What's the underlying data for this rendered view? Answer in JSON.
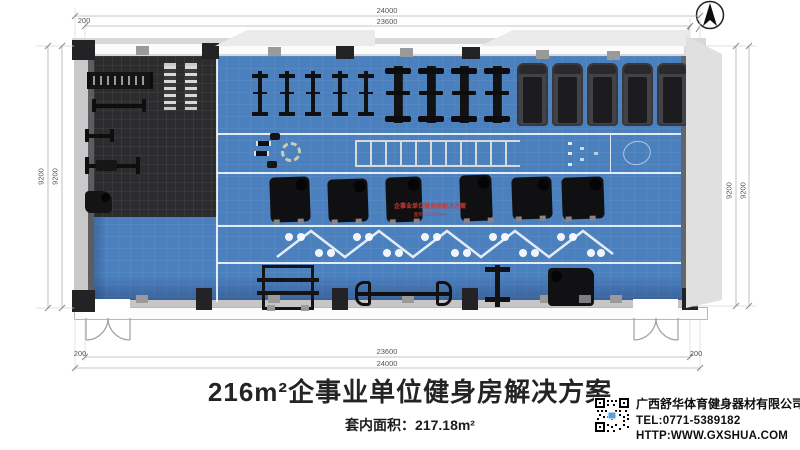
{
  "dimensions": {
    "top_outer": "24000",
    "top_inner": "23600",
    "top_offset": "200",
    "bottom_inner": "23600",
    "bottom_outer": "24000",
    "bottom_offset_left": "200",
    "bottom_offset_right": "200",
    "left_outer": "9200",
    "left_inner": "9200",
    "right_inner": "9200",
    "right_outer": "9200"
  },
  "plan": {
    "annotation": {
      "line1": "企事业单位健身房解决方案",
      "line2": "面积:216.57m²"
    },
    "colors": {
      "floor_blue": "#4b80bf",
      "mat_dark": "#2c2c2f",
      "wall_light": "#d8d8d8",
      "equipment_dark": "#141414",
      "annotation_red": "#d03a2e"
    },
    "structures": [
      {
        "kind": "column",
        "x": 72,
        "y": 40,
        "w": 23,
        "h": 20
      },
      {
        "kind": "column",
        "x": 202,
        "y": 43,
        "w": 17,
        "h": 16
      },
      {
        "kind": "column",
        "x": 336,
        "y": 45,
        "w": 18,
        "h": 14
      },
      {
        "kind": "column",
        "x": 462,
        "y": 47,
        "w": 18,
        "h": 12
      },
      {
        "kind": "column",
        "x": 688,
        "y": 56,
        "w": 14,
        "h": 16
      },
      {
        "kind": "column",
        "x": 72,
        "y": 290,
        "w": 23,
        "h": 22
      },
      {
        "kind": "column",
        "x": 196,
        "y": 288,
        "w": 16,
        "h": 22
      },
      {
        "kind": "column",
        "x": 332,
        "y": 288,
        "w": 16,
        "h": 22
      },
      {
        "kind": "column",
        "x": 462,
        "y": 288,
        "w": 16,
        "h": 22
      },
      {
        "kind": "column",
        "x": 682,
        "y": 288,
        "w": 16,
        "h": 22
      },
      {
        "kind": "wall-tick",
        "x": 136,
        "y": 46,
        "w": 13,
        "h": 9
      },
      {
        "kind": "wall-tick",
        "x": 268,
        "y": 47,
        "w": 13,
        "h": 9
      },
      {
        "kind": "wall-tick",
        "x": 400,
        "y": 48,
        "w": 13,
        "h": 9
      },
      {
        "kind": "wall-tick",
        "x": 536,
        "y": 50,
        "w": 13,
        "h": 9
      },
      {
        "kind": "wall-tick",
        "x": 607,
        "y": 51,
        "w": 13,
        "h": 9
      },
      {
        "kind": "wall-tick",
        "x": 136,
        "y": 295,
        "w": 12,
        "h": 8
      },
      {
        "kind": "wall-tick",
        "x": 268,
        "y": 295,
        "w": 12,
        "h": 8
      },
      {
        "kind": "wall-tick",
        "x": 402,
        "y": 295,
        "w": 12,
        "h": 8
      },
      {
        "kind": "wall-tick",
        "x": 540,
        "y": 295,
        "w": 12,
        "h": 8
      },
      {
        "kind": "wall-tick",
        "x": 610,
        "y": 295,
        "w": 12,
        "h": 8
      }
    ],
    "equipment": [
      {
        "kind": "dumbbell-rack",
        "x": 87,
        "y": 72,
        "w": 60,
        "h": 17
      },
      {
        "kind": "plate-rack",
        "x": 164,
        "y": 63,
        "w": 12,
        "h": 41
      },
      {
        "kind": "plate-rack",
        "x": 185,
        "y": 63,
        "w": 12,
        "h": 41
      },
      {
        "kind": "flat-bench",
        "x": 92,
        "y": 99,
        "w": 46,
        "h": 13
      },
      {
        "kind": "accessory-bench",
        "x": 85,
        "y": 129,
        "w": 21,
        "h": 13
      },
      {
        "kind": "bench-press",
        "x": 85,
        "y": 157,
        "w": 47,
        "h": 17
      },
      {
        "kind": "preacher-bench",
        "x": 85,
        "y": 191,
        "w": 27,
        "h": 22
      },
      {
        "kind": "elliptical",
        "x": 250,
        "y": 71,
        "w": 20,
        "h": 45
      },
      {
        "kind": "elliptical",
        "x": 277,
        "y": 71,
        "w": 20,
        "h": 45
      },
      {
        "kind": "elliptical",
        "x": 303,
        "y": 71,
        "w": 20,
        "h": 45
      },
      {
        "kind": "elliptical",
        "x": 330,
        "y": 71,
        "w": 20,
        "h": 45
      },
      {
        "kind": "elliptical",
        "x": 356,
        "y": 71,
        "w": 20,
        "h": 45
      },
      {
        "kind": "spin-bike",
        "x": 385,
        "y": 66,
        "w": 26,
        "h": 57
      },
      {
        "kind": "spin-bike",
        "x": 418,
        "y": 66,
        "w": 26,
        "h": 57
      },
      {
        "kind": "spin-bike",
        "x": 451,
        "y": 66,
        "w": 26,
        "h": 57
      },
      {
        "kind": "spin-bike",
        "x": 484,
        "y": 66,
        "w": 26,
        "h": 57
      },
      {
        "kind": "treadmill",
        "x": 517,
        "y": 63,
        "w": 31,
        "h": 63
      },
      {
        "kind": "treadmill",
        "x": 552,
        "y": 63,
        "w": 31,
        "h": 63
      },
      {
        "kind": "treadmill",
        "x": 587,
        "y": 63,
        "w": 31,
        "h": 63
      },
      {
        "kind": "treadmill",
        "x": 622,
        "y": 63,
        "w": 31,
        "h": 63
      },
      {
        "kind": "treadmill",
        "x": 657,
        "y": 63,
        "w": 31,
        "h": 63
      },
      {
        "kind": "mini-dumbbell",
        "x": 256,
        "y": 141,
        "w": 11,
        "h": 5
      },
      {
        "kind": "mini-dumbbell",
        "x": 254,
        "y": 151,
        "w": 11,
        "h": 5
      },
      {
        "kind": "mini-mat",
        "x": 270,
        "y": 133,
        "w": 10,
        "h": 7
      },
      {
        "kind": "mini-mat",
        "x": 267,
        "y": 161,
        "w": 10,
        "h": 7
      },
      {
        "kind": "yoga-ring",
        "x": 281,
        "y": 142,
        "w": 20,
        "h": 20
      },
      {
        "kind": "agility-ladder",
        "x": 355,
        "y": 140,
        "w": 165,
        "h": 27
      },
      {
        "kind": "stretch-marks",
        "x": 560,
        "y": 134,
        "w": 96,
        "h": 38
      },
      {
        "kind": "strength-machine",
        "x": 270,
        "y": 177,
        "w": 40,
        "h": 45
      },
      {
        "kind": "strength-machine",
        "x": 328,
        "y": 179,
        "w": 40,
        "h": 43
      },
      {
        "kind": "strength-machine",
        "x": 386,
        "y": 177,
        "w": 36,
        "h": 45
      },
      {
        "kind": "strength-machine",
        "x": 460,
        "y": 175,
        "w": 32,
        "h": 46
      },
      {
        "kind": "strength-machine",
        "x": 512,
        "y": 177,
        "w": 40,
        "h": 42
      },
      {
        "kind": "strength-machine",
        "x": 562,
        "y": 177,
        "w": 42,
        "h": 42
      },
      {
        "kind": "power-rack",
        "x": 262,
        "y": 265,
        "w": 52,
        "h": 45
      },
      {
        "kind": "barbell-rack",
        "x": 355,
        "y": 281,
        "w": 97,
        "h": 25
      },
      {
        "kind": "vertical-machine",
        "x": 485,
        "y": 265,
        "w": 25,
        "h": 42
      },
      {
        "kind": "plate-machine",
        "x": 548,
        "y": 268,
        "w": 46,
        "h": 38
      }
    ]
  },
  "title_block": {
    "title": "216m²企事业单位健身房解决方案",
    "area_label": "套内面积：217.18m²"
  },
  "company": {
    "name": "广西舒华体育健身器材有限公司",
    "tel": "TEL:0771-5389182",
    "website": "HTTP:WWW.GXSHUA.COM"
  }
}
